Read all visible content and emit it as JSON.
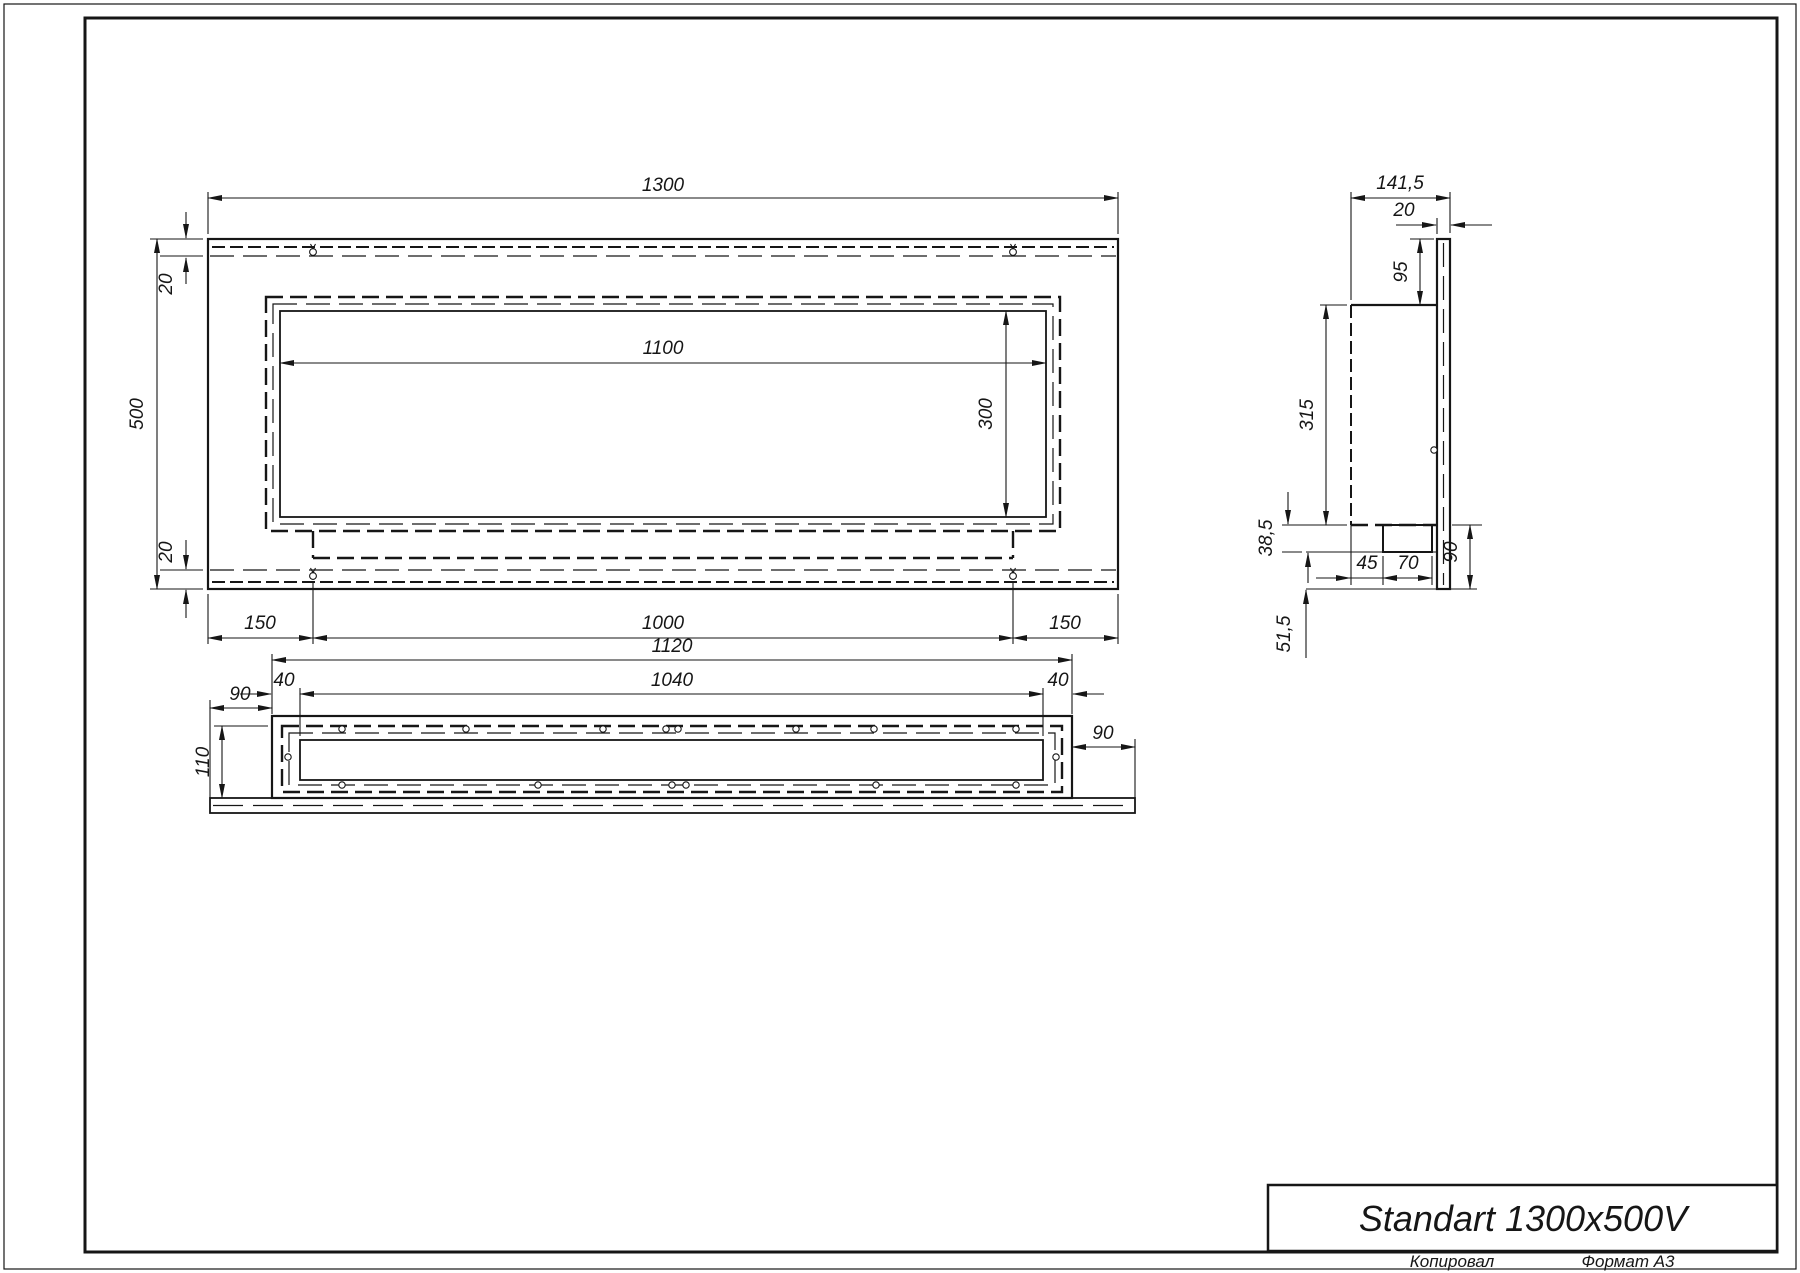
{
  "title_block": {
    "model": "Standart 1300x500V",
    "copied": "Копировал",
    "format": "Формат А3"
  },
  "front_view": {
    "width": "1300",
    "height": "500",
    "flange_top": "20",
    "flange_bottom": "20",
    "opening_width": "1100",
    "opening_height": "300",
    "margin_left": "150",
    "bottom_center": "1000",
    "margin_right": "150"
  },
  "side_view": {
    "depth": "141,5",
    "panel_thickness": "20",
    "top_offset": "95",
    "box_height": "315",
    "band_height": "38,5",
    "offset_45": "45",
    "burner_width": "70",
    "overhang": "90",
    "bottom_offset": "51,5"
  },
  "bottom_view": {
    "length": "1120",
    "inner_length": "1040",
    "margin_left": "40",
    "margin_right": "40",
    "overhang_left": "90",
    "overhang_right": "90",
    "depth": "110"
  }
}
